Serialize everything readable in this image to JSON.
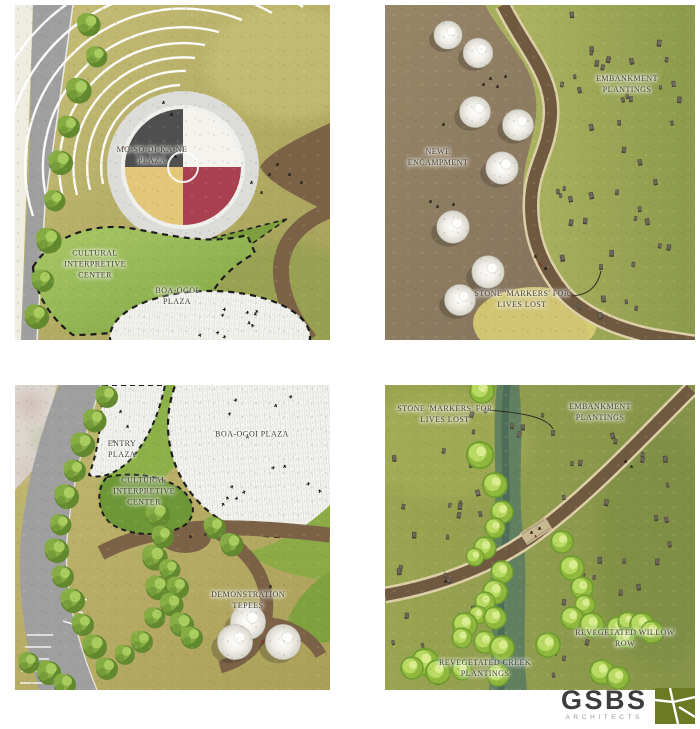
{
  "sheet": {
    "background": "#ffffff"
  },
  "quadrants": {
    "top_left": {
      "labels": {
        "mosodikane_plaza": {
          "line1": "MO-SO-DI-KA-NE",
          "line2": "PLAZA"
        },
        "cultural_interpretive_center": {
          "line1": "CULTURAL",
          "line2": "INTERPRETIVE",
          "line3": "CENTER"
        },
        "boa_ogoi_plaza": {
          "line1": "BOA-OGOI",
          "line2": "PLAZA"
        }
      }
    },
    "top_right": {
      "labels": {
        "newe_encampment": {
          "line1": "NEWE",
          "line2": "ENCAMPMENT"
        },
        "embankment_plantings": {
          "line1": "EMBANKMENT",
          "line2": "PLANTINGS"
        },
        "stone_markers": {
          "line1": "STONE 'MARKERS' FOR",
          "line2": "LIVES LOST"
        }
      }
    },
    "bottom_left": {
      "labels": {
        "entry_plaza": {
          "line1": "ENTRY",
          "line2": "PLAZA"
        },
        "boa_ogoi_plaza": {
          "line1": "BOA-OGOI PLAZA"
        },
        "cultural_interpretive_center": {
          "line1": "CULTURAL",
          "line2": "INTERPRETIVE",
          "line3": "CENTER"
        },
        "demonstration_tepees": {
          "line1": "DEMONSTRATION",
          "line2": "TEPEES"
        }
      }
    },
    "bottom_right": {
      "labels": {
        "stone_markers": {
          "line1": "STONE 'MARKERS' FOR",
          "line2": "LIVES LOST"
        },
        "embankment_plantings": {
          "line1": "EMBANKMENT",
          "line2": "PLANTINGS"
        },
        "revegetated_willow_row": {
          "line1": "REVEGETATED WILLOW",
          "line2": "ROW"
        },
        "revegetated_creek_plantings": {
          "line1": "REVEGETATED CREEK",
          "line2": "PLANTINGS"
        }
      }
    }
  },
  "logo": {
    "wordmark": "GSBS",
    "subtitle": "ARCHITECTS",
    "mark_icon": "field-pattern-square",
    "mark_color": "#6b7a23",
    "text_color": "#3d3d3d"
  },
  "colors": {
    "plaza_dark": "#4f4f4f",
    "plaza_white": "#f4f3ee",
    "plaza_gold": "#e4c679",
    "plaza_red": "#a8404f",
    "trail_brown": "#6f5940",
    "planting_bed_brown": "#7b6247",
    "grass_olive": "#b3ab63",
    "embankment_green": "#93a04e",
    "creek_teal": "#587a63",
    "dirt_brown": "#8d7c60",
    "road_gray": "#9e9e9e"
  }
}
